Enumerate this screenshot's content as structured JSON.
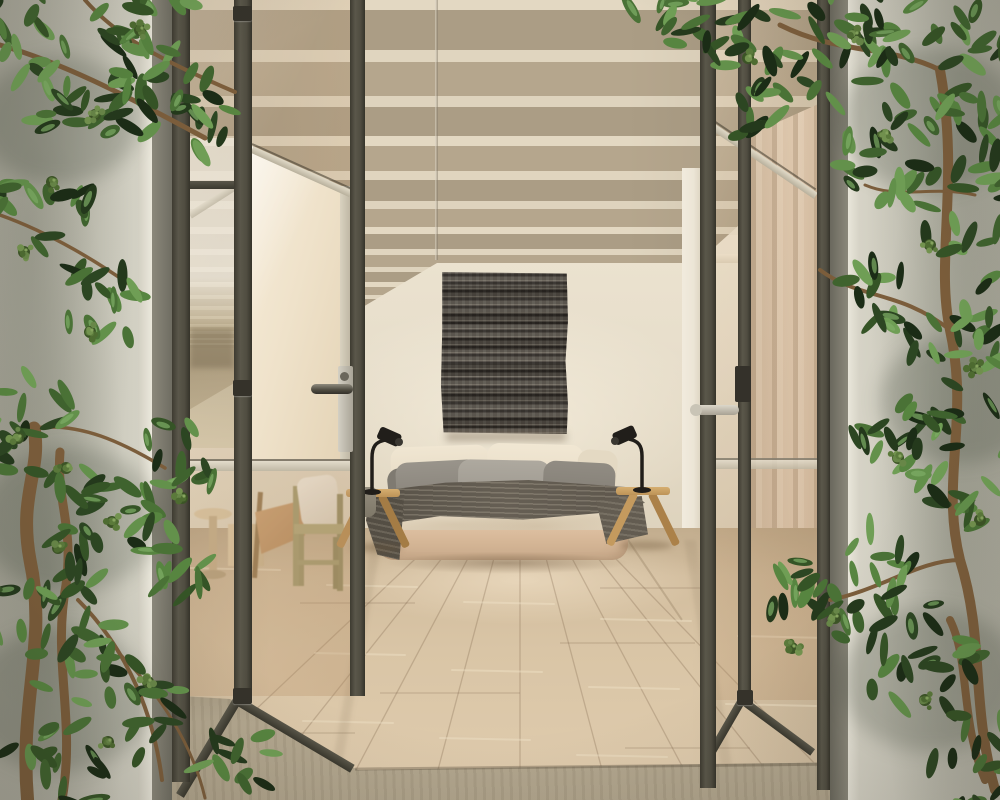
{
  "scene": {
    "kind": "photographic interior rendering",
    "subject": "minimalist bedroom seen through open steel-framed glass doors, flanked by climbing plants on plaster walls",
    "visible_text": "none"
  },
  "objects": {
    "ceiling": "exposed parallel wood beams",
    "wall_art": "dark woven textured tapestry above bed",
    "bed": "upholstered double bed with cream duvet, cream and gray pillows, dark gray throw",
    "lamps": "two black gooseneck table lamps on wooden x-frame stools",
    "side_tables": "wooden x-frame stools flanking bed",
    "left_furniture": "wooden chair with white cushion, leather sling chair, round side table, cube stool",
    "doors": "dark steel-framed glass bifold doors, one bright pane folded open, lever handles",
    "curtain": "beige floor-length curtain behind right glass",
    "floor": "light oak plank floor with stone threshold",
    "plants": "glossy green climbing vines with green flower clusters on both walls"
  },
  "palette": {
    "back_wall": "#e7decb",
    "beam_dark": "#ac9e86",
    "beam_light": "#e0d5bf",
    "wood_floor": "#d4c0a2",
    "stone_floor": "#b2a68e",
    "door_frame": "#4e4b40",
    "frame_light": "#d6cfbd",
    "glass_tint": "rgba(214,177,136,0.17)",
    "curtain": "#dbc7b0",
    "bed_base": "#ddc0a2",
    "duvet": "#f2e8d6",
    "pillow_cream": "#eadfc9",
    "pillow_gray": "#948f86",
    "throw": "#5f584d",
    "art_dark": "#45403a",
    "plaster_wall": "#c9c7ba",
    "lamp_black": "#211e1a",
    "stool_wood": "#c9a263",
    "leaf_dark": "#24391c",
    "leaf_mid": "#3f632e",
    "leaf_light": "#63914b",
    "flower_green": "#5b7a3b",
    "branch_brown": "#7b5d3b"
  }
}
